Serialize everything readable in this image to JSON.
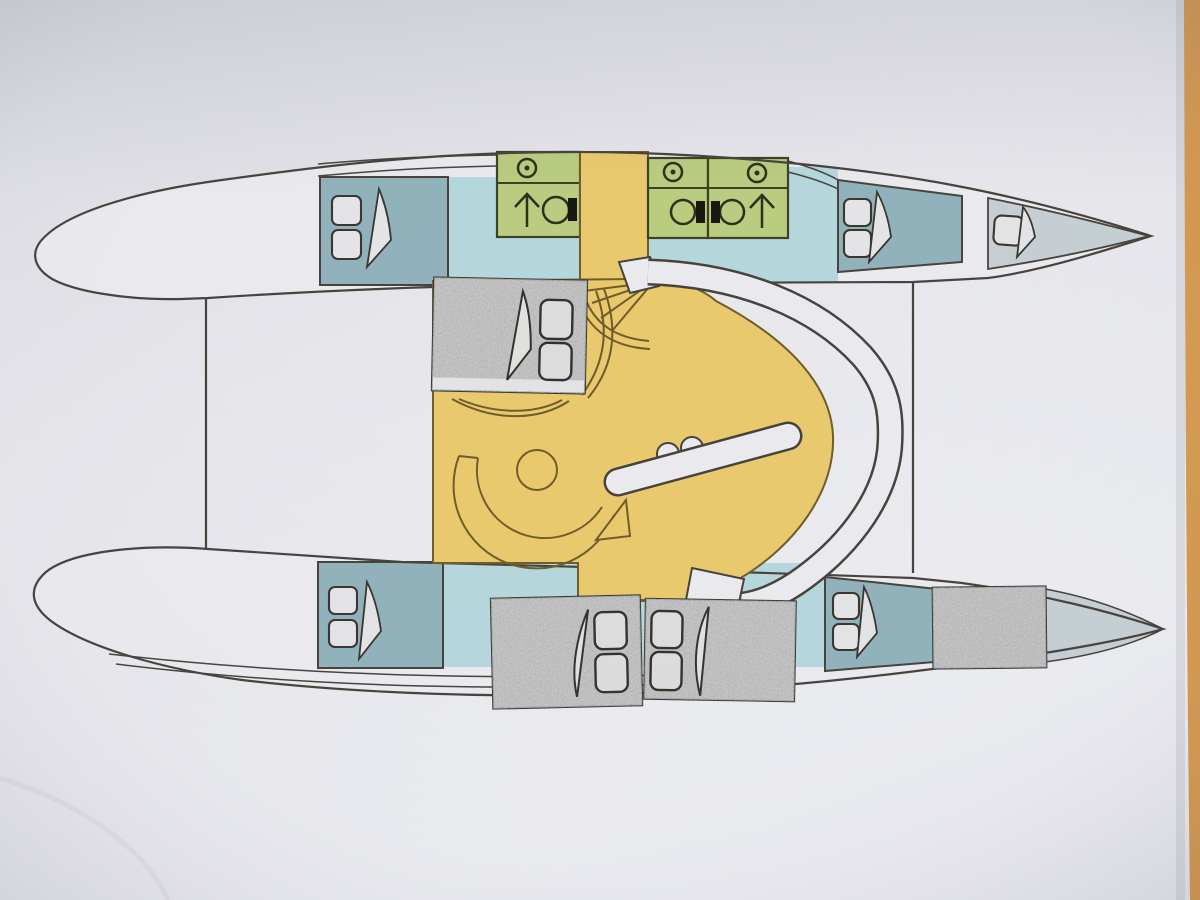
{
  "photo": {
    "subject": "catamaran-interior-deck-plan-on-paper",
    "orientation": "bows-pointing-right",
    "modifications": "grey paper berth cut-outs pasted onto printed plan"
  },
  "palette": {
    "paper": "#e6e6eb",
    "paper-shadow": "#c9c9d2",
    "table": "#d5994f",
    "line": "#46413b",
    "hull": "#ebebef",
    "cabin": "#90b2bb",
    "corridor": "#b5d7dc",
    "head": "#b9cc7e",
    "head-line": "#3e3e23",
    "saloon": "#e9c96d",
    "saloon-line": "#6e5c29",
    "cutout": "#949494",
    "cutout-line": "#3a3a35",
    "bow": "#c6cfd4",
    "fixture": "#eaeaee",
    "pillow": "#e4e4e6",
    "black": "#17160f"
  },
  "plan": {
    "hulls": [
      "port",
      "starboard"
    ],
    "heads_count": 3,
    "shower_icons": 3,
    "toilet_icons": 3,
    "walkway_arrows": 2,
    "printed_berths": 5,
    "pasted_cutout_berths": 3,
    "pasted_patches": 1
  },
  "icons": {
    "shower": "circle-with-center-dot",
    "toilet": "circle-with-black-cistern",
    "walkway": "up-arrow",
    "berth": "two-pillows-with-folded-blanket"
  }
}
